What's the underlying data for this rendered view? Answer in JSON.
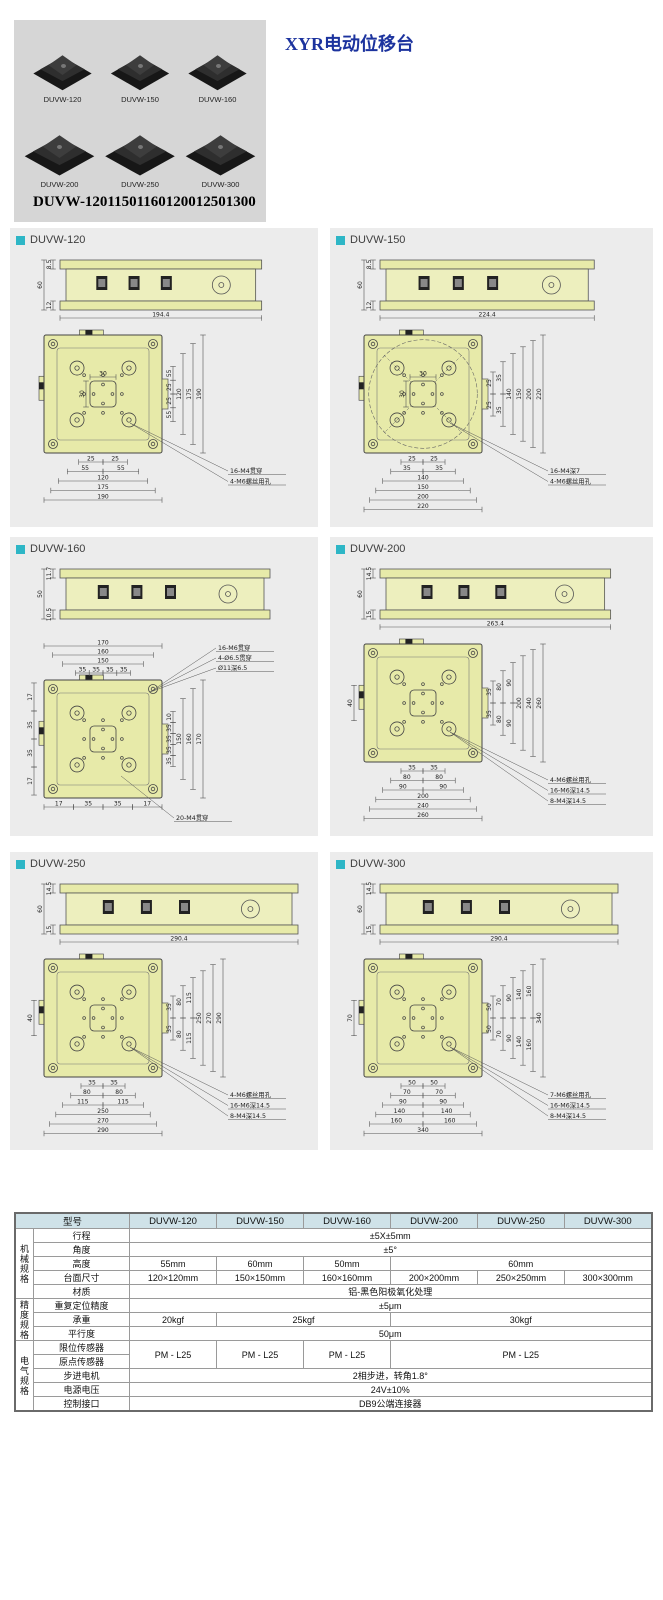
{
  "header": {
    "title": "XYR电动位移台",
    "title_color": "#1c339e",
    "products": [
      {
        "label": "DUVW-120"
      },
      {
        "label": "DUVW-150"
      },
      {
        "label": "DUVW-160"
      },
      {
        "label": "DUVW-200"
      },
      {
        "label": "DUVW-250"
      },
      {
        "label": "DUVW-300"
      }
    ]
  },
  "subtitle": "DUVW-12011501160120012501300",
  "colors": {
    "section_bullet": "#2eb6c6",
    "panel_bg": "#ececec",
    "drawing_fill": "#e7eaa9",
    "table_header_bg": "#cfe2e8",
    "photo_panel_bg": "#d6d6d6"
  },
  "sections": [
    {
      "id": "DUVW-120",
      "side": {
        "height": "60",
        "top": "8.5",
        "bottom": "12",
        "width": "194.4"
      },
      "top": {
        "center_dims": [
          "30",
          "30"
        ],
        "right_cols": [
          [
            "55",
            "25",
            "25",
            "55"
          ],
          [
            "120"
          ],
          [
            "175"
          ],
          [
            "190"
          ]
        ],
        "bottom_rows": [
          [
            "25",
            "25"
          ],
          [
            "55",
            "55"
          ],
          [
            "120"
          ],
          [
            "175"
          ],
          [
            "190"
          ]
        ],
        "notes": [
          {
            "text": "16-M4贯穿",
            "pos": "br"
          },
          {
            "text": "4-M6螺丝用孔",
            "pos": "br"
          }
        ]
      }
    },
    {
      "id": "DUVW-150",
      "side": {
        "height": "60",
        "top": "8.5",
        "bottom": "12",
        "width": "224.4"
      },
      "top": {
        "inscribed_circle": true,
        "center_dims": [
          "30",
          "30"
        ],
        "right_cols": [
          [
            "25",
            "25"
          ],
          [
            "35",
            "35"
          ],
          [
            "140"
          ],
          [
            "150"
          ],
          [
            "200"
          ],
          [
            "220"
          ]
        ],
        "bottom_rows": [
          [
            "25",
            "25"
          ],
          [
            "35",
            "35"
          ],
          [
            "140"
          ],
          [
            "150"
          ],
          [
            "200"
          ],
          [
            "220"
          ]
        ],
        "notes": [
          {
            "text": "16-M4深7",
            "pos": "br"
          },
          {
            "text": "4-M6螺丝用孔",
            "pos": "br"
          }
        ]
      }
    },
    {
      "id": "DUVW-160",
      "side": {
        "height": "50",
        "top": "11.7",
        "bottom": "10.5",
        "width": ""
      },
      "top": {
        "top_rows": [
          [
            "35",
            "35",
            "35",
            "35"
          ],
          [
            "150"
          ],
          [
            "160"
          ],
          [
            "170"
          ]
        ],
        "left_cols": [
          [
            "17",
            "35",
            "35",
            "17"
          ]
        ],
        "right_cols": [
          [
            "10",
            "35",
            "35",
            "35",
            "35"
          ],
          [
            "150"
          ],
          [
            "160"
          ],
          [
            "170"
          ]
        ],
        "bottom_rows": [
          [
            "17",
            "35",
            "35",
            "17"
          ]
        ],
        "notes": [
          {
            "text": "16-M6贯穿",
            "pos": "tr"
          },
          {
            "text": "4-Ø6.5贯穿",
            "pos": "tr"
          },
          {
            "text": "Ø11深6.5",
            "pos": "tr"
          },
          {
            "text": "20-M4贯穿",
            "pos": "b"
          }
        ]
      }
    },
    {
      "id": "DUVW-200",
      "side": {
        "height": "60",
        "top": "14.5",
        "bottom": "15",
        "width": "263.4"
      },
      "top": {
        "left_cols": [
          [
            "40"
          ]
        ],
        "right_cols": [
          [
            "35",
            "35"
          ],
          [
            "80",
            "80"
          ],
          [
            "90",
            "90"
          ],
          [
            "200"
          ],
          [
            "240"
          ],
          [
            "260"
          ]
        ],
        "bottom_rows": [
          [
            "35",
            "35"
          ],
          [
            "80",
            "80"
          ],
          [
            "90",
            "90"
          ],
          [
            "200"
          ],
          [
            "240"
          ],
          [
            "260"
          ]
        ],
        "notes": [
          {
            "text": "4-M6螺丝用孔",
            "pos": "br"
          },
          {
            "text": "16-M6深14.5",
            "pos": "br"
          },
          {
            "text": "8-M4深14.5",
            "pos": "br"
          }
        ]
      }
    },
    {
      "id": "DUVW-250",
      "side": {
        "height": "60",
        "top": "14.5",
        "bottom": "15",
        "width": "290.4"
      },
      "top": {
        "left_cols": [
          [
            "40"
          ]
        ],
        "right_cols": [
          [
            "35",
            "35"
          ],
          [
            "80",
            "80"
          ],
          [
            "115",
            "115"
          ],
          [
            "250"
          ],
          [
            "270"
          ],
          [
            "290"
          ]
        ],
        "bottom_rows": [
          [
            "35",
            "35"
          ],
          [
            "80",
            "80"
          ],
          [
            "115",
            "115"
          ],
          [
            "250"
          ],
          [
            "270"
          ],
          [
            "290"
          ]
        ],
        "notes": [
          {
            "text": "4-M6螺丝用孔",
            "pos": "br"
          },
          {
            "text": "16-M6深14.5",
            "pos": "br"
          },
          {
            "text": "8-M4深14.5",
            "pos": "br"
          }
        ]
      }
    },
    {
      "id": "DUVW-300",
      "side": {
        "height": "60",
        "top": "14.5",
        "bottom": "15",
        "width": "290.4"
      },
      "top": {
        "left_cols": [
          [
            "70"
          ]
        ],
        "right_cols": [
          [
            "50",
            "50"
          ],
          [
            "70",
            "70"
          ],
          [
            "90",
            "90"
          ],
          [
            "140",
            "140"
          ],
          [
            "160",
            "160"
          ],
          [
            "340"
          ]
        ],
        "bottom_rows": [
          [
            "50",
            "50"
          ],
          [
            "70",
            "70"
          ],
          [
            "90",
            "90"
          ],
          [
            "140",
            "140"
          ],
          [
            "160",
            "160"
          ],
          [
            "340"
          ]
        ],
        "notes": [
          {
            "text": "7-M6螺丝用孔",
            "pos": "br"
          },
          {
            "text": "16-M6深14.5",
            "pos": "br"
          },
          {
            "text": "8-M4深14.5",
            "pos": "br"
          }
        ]
      }
    }
  ],
  "spec_table": {
    "model_label": "型号",
    "models": [
      "DUVW-120",
      "DUVW-150",
      "DUVW-160",
      "DUVW-200",
      "DUVW-250",
      "DUVW-300"
    ],
    "groups": [
      {
        "label": "机械规格",
        "rows": [
          {
            "label": "行程",
            "cells": [
              {
                "text": "±5X±5mm",
                "span": 6
              }
            ]
          },
          {
            "label": "角度",
            "cells": [
              {
                "text": "±5°",
                "span": 6
              }
            ]
          },
          {
            "label": "高度",
            "cells": [
              {
                "text": "55mm",
                "span": 1
              },
              {
                "text": "60mm",
                "span": 1
              },
              {
                "text": "50mm",
                "span": 1
              },
              {
                "text": "60mm",
                "span": 3
              }
            ]
          },
          {
            "label": "台面尺寸",
            "cells": [
              {
                "text": "120×120mm",
                "span": 1
              },
              {
                "text": "150×150mm",
                "span": 1
              },
              {
                "text": "160×160mm",
                "span": 1
              },
              {
                "text": "200×200mm",
                "span": 1
              },
              {
                "text": "250×250mm",
                "span": 1
              },
              {
                "text": "300×300mm",
                "span": 1
              }
            ]
          },
          {
            "label": "材质",
            "cells": [
              {
                "text": "铝-黑色阳极氧化处理",
                "span": 6
              }
            ]
          }
        ]
      },
      {
        "label": "精度规格",
        "rows": [
          {
            "label": "重复定位精度",
            "cells": [
              {
                "text": "±5μm",
                "span": 6
              }
            ]
          },
          {
            "label": "承重",
            "cells": [
              {
                "text": "20kgf",
                "span": 1
              },
              {
                "text": "25kgf",
                "span": 2
              },
              {
                "text": "30kgf",
                "span": 3
              }
            ]
          },
          {
            "label": "平行度",
            "cells": [
              {
                "text": "50μm",
                "span": 6
              }
            ]
          }
        ]
      },
      {
        "label": "电气规格",
        "rows": [
          {
            "label": "限位传感器",
            "cells": [
              {
                "text": "PM - L25",
                "span": 1,
                "rowspan": 2
              },
              {
                "text": "PM - L25",
                "span": 1,
                "rowspan": 2
              },
              {
                "text": "PM - L25",
                "span": 1,
                "rowspan": 2
              },
              {
                "text": "PM - L25",
                "span": 3,
                "rowspan": 2
              }
            ]
          },
          {
            "label": "原点传感器",
            "cells": []
          },
          {
            "label": "步进电机",
            "cells": [
              {
                "text": "2相步进，转角1.8°",
                "span": 6
              }
            ]
          },
          {
            "label": "电源电压",
            "cells": [
              {
                "text": "24V±10%",
                "span": 6
              }
            ]
          },
          {
            "label": "控制接口",
            "cells": [
              {
                "text": "DB9公端连接器",
                "span": 6
              }
            ]
          }
        ]
      }
    ]
  }
}
